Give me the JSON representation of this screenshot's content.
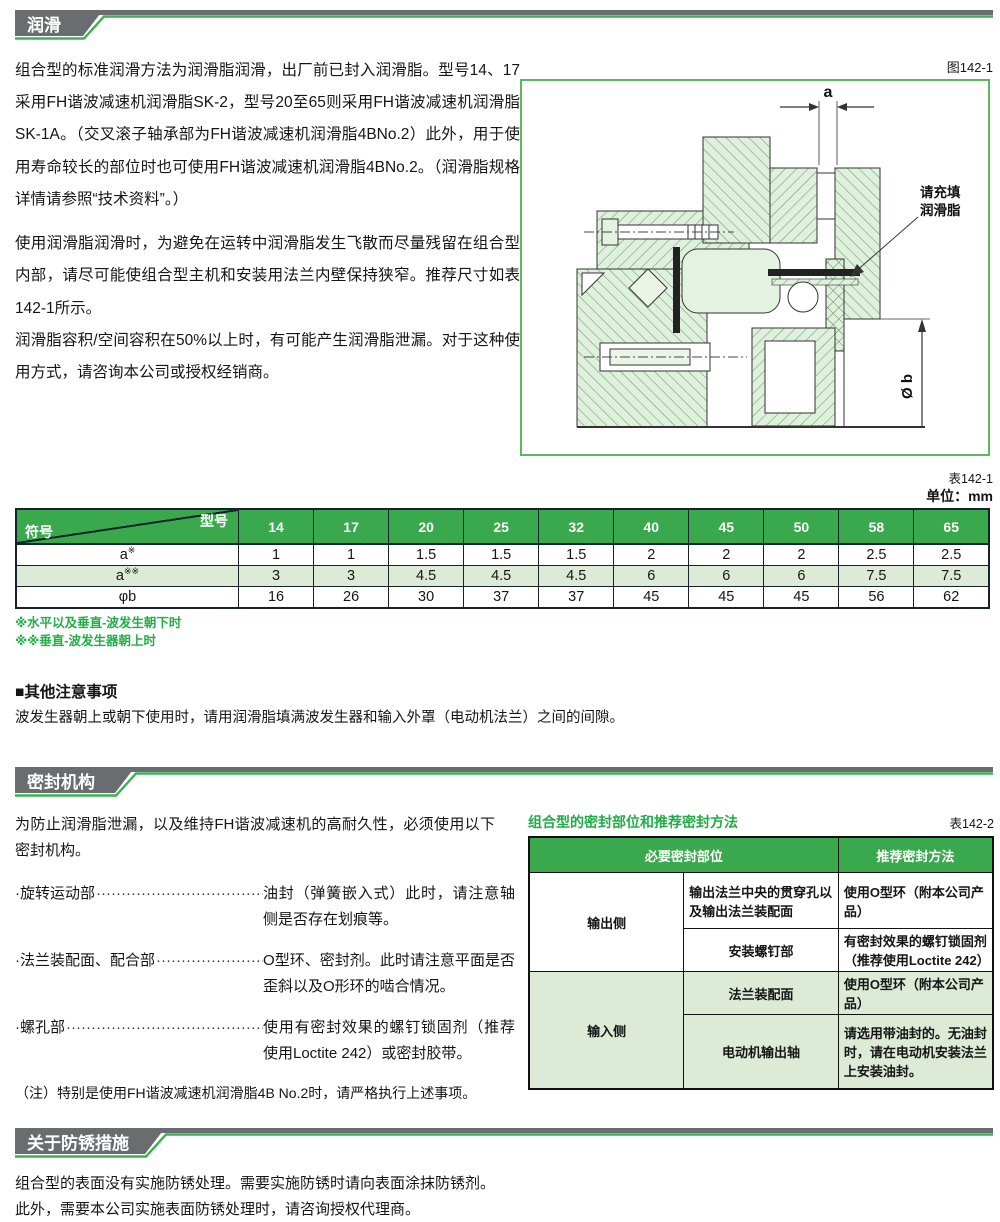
{
  "colors": {
    "accent_green": "#3cb054",
    "table_header_green": "#3aa94d",
    "row_light_green": "#dcead6",
    "tab_gray": "#6a6d70",
    "note_green": "#23ac47",
    "diagram_border_green": "#5cb860"
  },
  "lubrication": {
    "tab": "润滑",
    "fig_label": "图142-1",
    "p1": "组合型的标准润滑方法为润滑脂润滑，出厂前已封入润滑脂。型号14、17采用FH谐波减速机润滑脂SK-2，型号20至65则采用FH谐波减速机润滑脂SK-1A。（交叉滚子轴承部为FH谐波减速机润滑脂4BNo.2）此外，用于使用寿命较长的部位时也可使用FH谐波减速机润滑脂4BNo.2。（润滑脂规格详情请参照“技术资料”。）",
    "p2": "使用润滑脂润滑时，为避免在运转中润滑脂发生飞散而尽量残留在组合型内部，请尽可能使组合型主机和安装用法兰内壁保持狭窄。推荐尺寸如表142-1所示。",
    "p3": "润滑脂容积/空间容积在50%以上时，有可能产生润滑脂泄漏。对于这种使用方式，请咨询本公司或授权经销商。",
    "diagram": {
      "dim_a": "a",
      "dim_b": "Ø b",
      "callout_line1": "请充填",
      "callout_line2": "润滑脂"
    }
  },
  "table1": {
    "label": "表142-1",
    "unit": "单位：mm",
    "corner_top": "型号",
    "corner_bottom": "符号",
    "models": [
      "14",
      "17",
      "20",
      "25",
      "32",
      "40",
      "45",
      "50",
      "58",
      "65"
    ],
    "rows": [
      {
        "sym": "a",
        "mark": "※",
        "values": [
          "1",
          "1",
          "1.5",
          "1.5",
          "1.5",
          "2",
          "2",
          "2",
          "2.5",
          "2.5"
        ]
      },
      {
        "sym": "a",
        "mark": "※※",
        "values": [
          "3",
          "3",
          "4.5",
          "4.5",
          "4.5",
          "6",
          "6",
          "6",
          "7.5",
          "7.5"
        ]
      },
      {
        "sym": "φb",
        "mark": "",
        "values": [
          "16",
          "26",
          "30",
          "37",
          "37",
          "45",
          "45",
          "45",
          "56",
          "62"
        ]
      }
    ],
    "notes": [
      "※水平以及垂直-波发生朝下时",
      "※※垂直-波发生器朝上时"
    ]
  },
  "other_notes": {
    "title": "■其他注意事项",
    "body": "波发生器朝上或朝下使用时，请用润滑脂填满波发生器和输入外罩（电动机法兰）之间的间隙。"
  },
  "sealing": {
    "tab": "密封机构",
    "intro": "为防止润滑脂泄漏，以及维持FH谐波减速机的高耐久性，必须使用以下密封机构。",
    "dots": "······························································",
    "items": [
      {
        "term": "·旋转运动部",
        "desc": "油封（弹簧嵌入式）此时，请注意轴侧是否存在划痕等。"
      },
      {
        "term": "·法兰装配面、配合部",
        "desc": "O型环、密封剂。此时请注意平面是否歪斜以及O形环的啮合情况。"
      },
      {
        "term": "·螺孔部",
        "desc": "使用有密封效果的螺钉锁固剂（推荐使用Loctite 242）或密封胶带。"
      }
    ],
    "note": "（注）特别是使用FH谐波减速机润滑脂4B No.2时，请严格执行上述事项。",
    "table2": {
      "title": "组合型的密封部位和推荐密封方法",
      "label": "表142-2",
      "col_head_1": "必要密封部位",
      "col_head_2": "推荐密封方法",
      "groups": [
        {
          "side": "输出侧",
          "rows": [
            {
              "part": "输出法兰中央的贯穿孔以及输出法兰装配面",
              "method": "使用O型环（附本公司产品）"
            },
            {
              "part": "安装螺钉部",
              "method": "有密封效果的螺钉锁固剂（推荐使用Loctite 242）"
            }
          ]
        },
        {
          "side": "输入侧",
          "rows": [
            {
              "part": "法兰装配面",
              "method": "使用O型环（附本公司产品）"
            },
            {
              "part": "电动机输出轴",
              "method": "请选用带油封的。无油封时，请在电动机安装法兰上安装油封。"
            }
          ]
        }
      ]
    }
  },
  "rust": {
    "tab": "关于防锈措施",
    "p1": "组合型的表面没有实施防锈处理。需要实施防锈时请向表面涂抹防锈剂。",
    "p2": "此外，需要本公司实施表面防锈处理时，请咨询授权代理商。"
  }
}
